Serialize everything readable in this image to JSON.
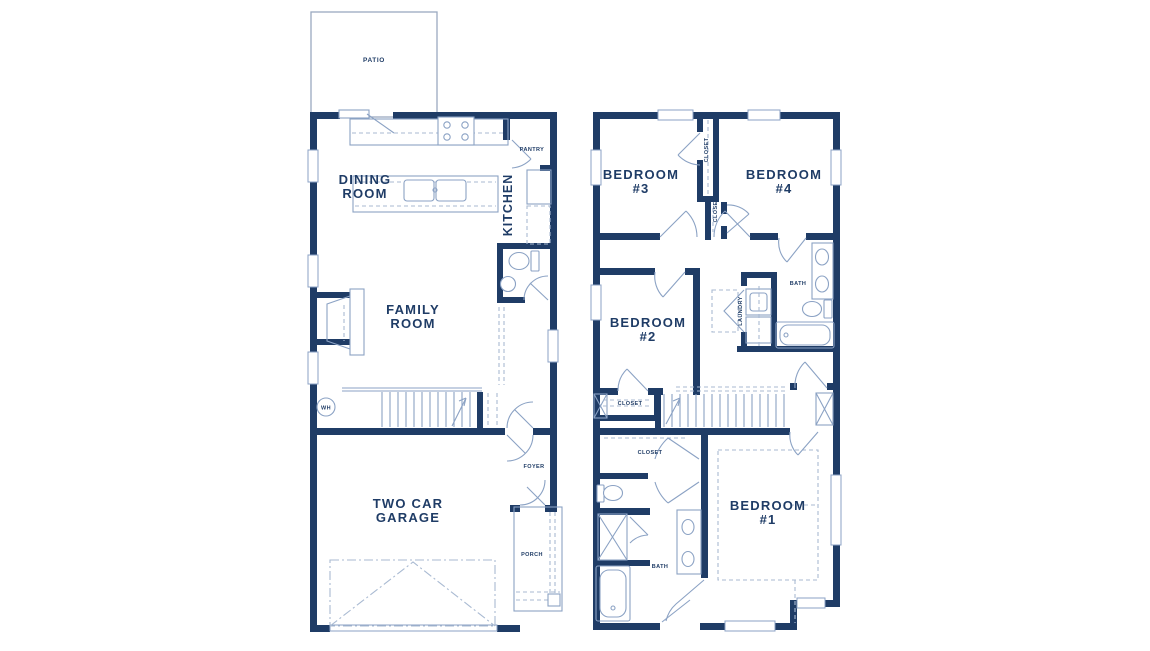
{
  "document": {
    "type": "floor-plan",
    "sheets": [
      "first-floor",
      "second-floor"
    ]
  },
  "colors": {
    "wall": "#1f3c66",
    "line": "#8ba2c4",
    "dash": "#a9bad2",
    "text": "#1f3c66",
    "patio_outline": "#9aa9c0",
    "background": "#ffffff"
  },
  "floor1": {
    "rooms": {
      "patio": {
        "label": "PATIO"
      },
      "dining": {
        "line1": "DINING",
        "line2": "ROOM"
      },
      "kitchen": {
        "label": "KITCHEN"
      },
      "pantry": {
        "label": "PANTRY"
      },
      "family": {
        "line1": "FAMILY",
        "line2": "ROOM"
      },
      "water_heater": {
        "label": "WH"
      },
      "foyer": {
        "label": "FOYER"
      },
      "garage": {
        "line1": "TWO CAR",
        "line2": "GARAGE"
      },
      "porch": {
        "label": "PORCH"
      }
    }
  },
  "floor2": {
    "rooms": {
      "bedroom3": {
        "line1": "BEDROOM",
        "line2": "#3"
      },
      "bedroom4": {
        "line1": "BEDROOM",
        "line2": "#4"
      },
      "closet_bedroom3": {
        "label": "CLOSET"
      },
      "closet_bedroom4": {
        "label": "CLOSET"
      },
      "bath_upper": {
        "label": "BATH"
      },
      "laundry": {
        "label": "LAUNDRY"
      },
      "bedroom2": {
        "line1": "BEDROOM",
        "line2": "#2"
      },
      "closet_bedroom2": {
        "label": "CLOSET"
      },
      "closet_walkin": {
        "label": "CLOSET"
      },
      "bath_lower": {
        "label": "BATH"
      },
      "bedroom1": {
        "line1": "BEDROOM",
        "line2": "#1"
      }
    }
  }
}
